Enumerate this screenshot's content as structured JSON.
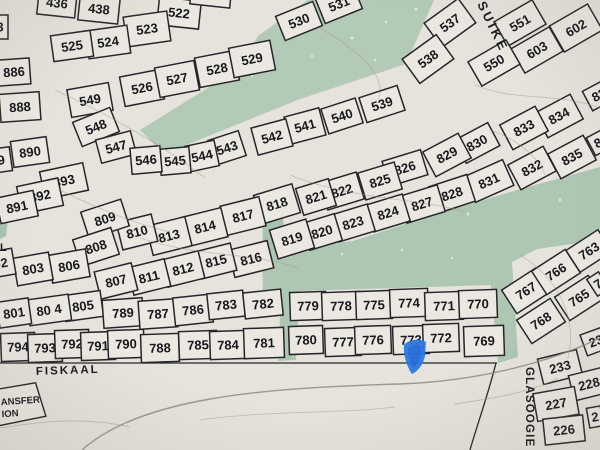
{
  "map": {
    "streets": {
      "fiskaal": "FISKAAL",
      "glasoogie": "GLASOOGIE",
      "suiker_partial": "SUIKE",
      "left_edge_partial": "L"
    },
    "station_box": {
      "line1": "ANSFER",
      "line2": "ION"
    },
    "colors": {
      "paper": "#e6e3dc",
      "plot_fill": "#ebe8e2",
      "boundary_line": "#26262a",
      "green_open_space": "#b2cab6",
      "green_strip": "#a9c3ae",
      "contour": "#9b9285",
      "marker_blue": "#2e79e2"
    },
    "plots": [
      "436",
      "438",
      "522",
      "521",
      "523",
      "524",
      "525",
      "3",
      "886",
      "888",
      "890",
      "889",
      "893",
      "892",
      "891",
      "549",
      "548",
      "547",
      "526",
      "527",
      "528",
      "529",
      "530",
      "531",
      "537",
      "538",
      "551",
      "602",
      "603",
      "550",
      "539",
      "540",
      "541",
      "542",
      "543",
      "544",
      "545",
      "546",
      "834",
      "833",
      "835",
      "832",
      "830",
      "829",
      "831",
      "83",
      "8",
      "826",
      "825",
      "822",
      "821",
      "818",
      "828",
      "827",
      "824",
      "823",
      "820",
      "819",
      "817",
      "814",
      "813",
      "810",
      "809",
      "808",
      "816",
      "815",
      "812",
      "811",
      "807",
      "806",
      "803",
      "802",
      "805",
      "80 4",
      "801",
      "789",
      "787",
      "786",
      "783",
      "782",
      "794",
      "793",
      "792",
      "791",
      "790",
      "788",
      "785",
      "784",
      "781",
      "779",
      "778",
      "775",
      "774",
      "771",
      "770",
      "780",
      "777",
      "776",
      "773",
      "772",
      "769",
      "768",
      "767",
      "766",
      "765",
      "763",
      "7",
      "233",
      "228",
      "227",
      "226",
      "23",
      "2"
    ]
  }
}
